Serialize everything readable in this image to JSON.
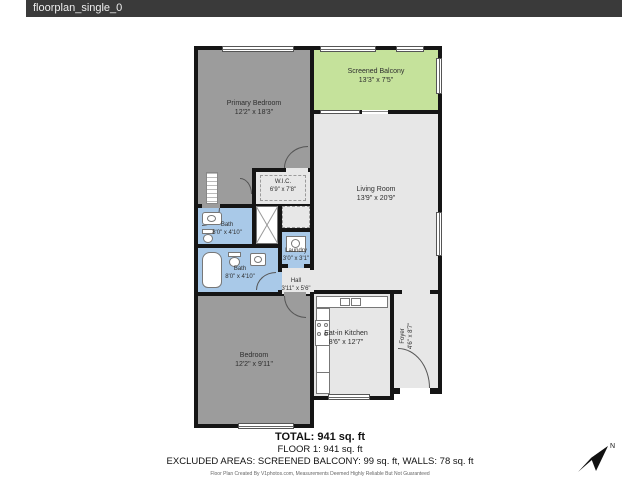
{
  "window": {
    "title": "floorplan_single_0"
  },
  "colors": {
    "titlebar_bg": "#3a3a3a",
    "wall": "#151515",
    "bedroom_fill": "#9c9c9c",
    "open_fill": "#e7e7e7",
    "bath_fill": "#a9c9e8",
    "balcony_fill": "#c5e29b"
  },
  "rooms": [
    {
      "id": "primary-bedroom",
      "name": "Primary Bedroom",
      "dims": "12'2\" x 18'3\""
    },
    {
      "id": "screened-balcony",
      "name": "Screened Balcony",
      "dims": "13'3\" x 7'5\""
    },
    {
      "id": "living-room",
      "name": "Living Room",
      "dims": "13'9\" x 20'9\""
    },
    {
      "id": "wic",
      "name": "W.I.C.",
      "dims": "6'9\" x 7'8\""
    },
    {
      "id": "bath-upper",
      "name": "Bath",
      "dims": "8'0\" x 4'10\""
    },
    {
      "id": "laundry",
      "name": "Laundry",
      "dims": "3'0\" x 3'1\""
    },
    {
      "id": "bath-lower",
      "name": "Bath",
      "dims": "8'0\" x 4'10\""
    },
    {
      "id": "hall",
      "name": "Hall",
      "dims": "3'11\" x 5'6\""
    },
    {
      "id": "bedroom",
      "name": "Bedroom",
      "dims": "12'2\" x 9'11\""
    },
    {
      "id": "eat-in-kitchen",
      "name": "Eat-in Kitchen",
      "dims": "8'6\" x 12'7\""
    },
    {
      "id": "foyer",
      "name": "Foyer",
      "dims": "4'6\" x 8'7\""
    }
  ],
  "summary": {
    "total": "TOTAL: 941 sq. ft",
    "floor": "FLOOR 1: 941 sq. ft",
    "excluded": "EXCLUDED AREAS: SCREENED BALCONY: 99 sq. ft, WALLS: 78 sq. ft",
    "disclaimer": "Floor Plan Created By V1photos.com, Measurements Deemed Highly Reliable But Not Guaranteed"
  },
  "compass": {
    "label": "N"
  }
}
